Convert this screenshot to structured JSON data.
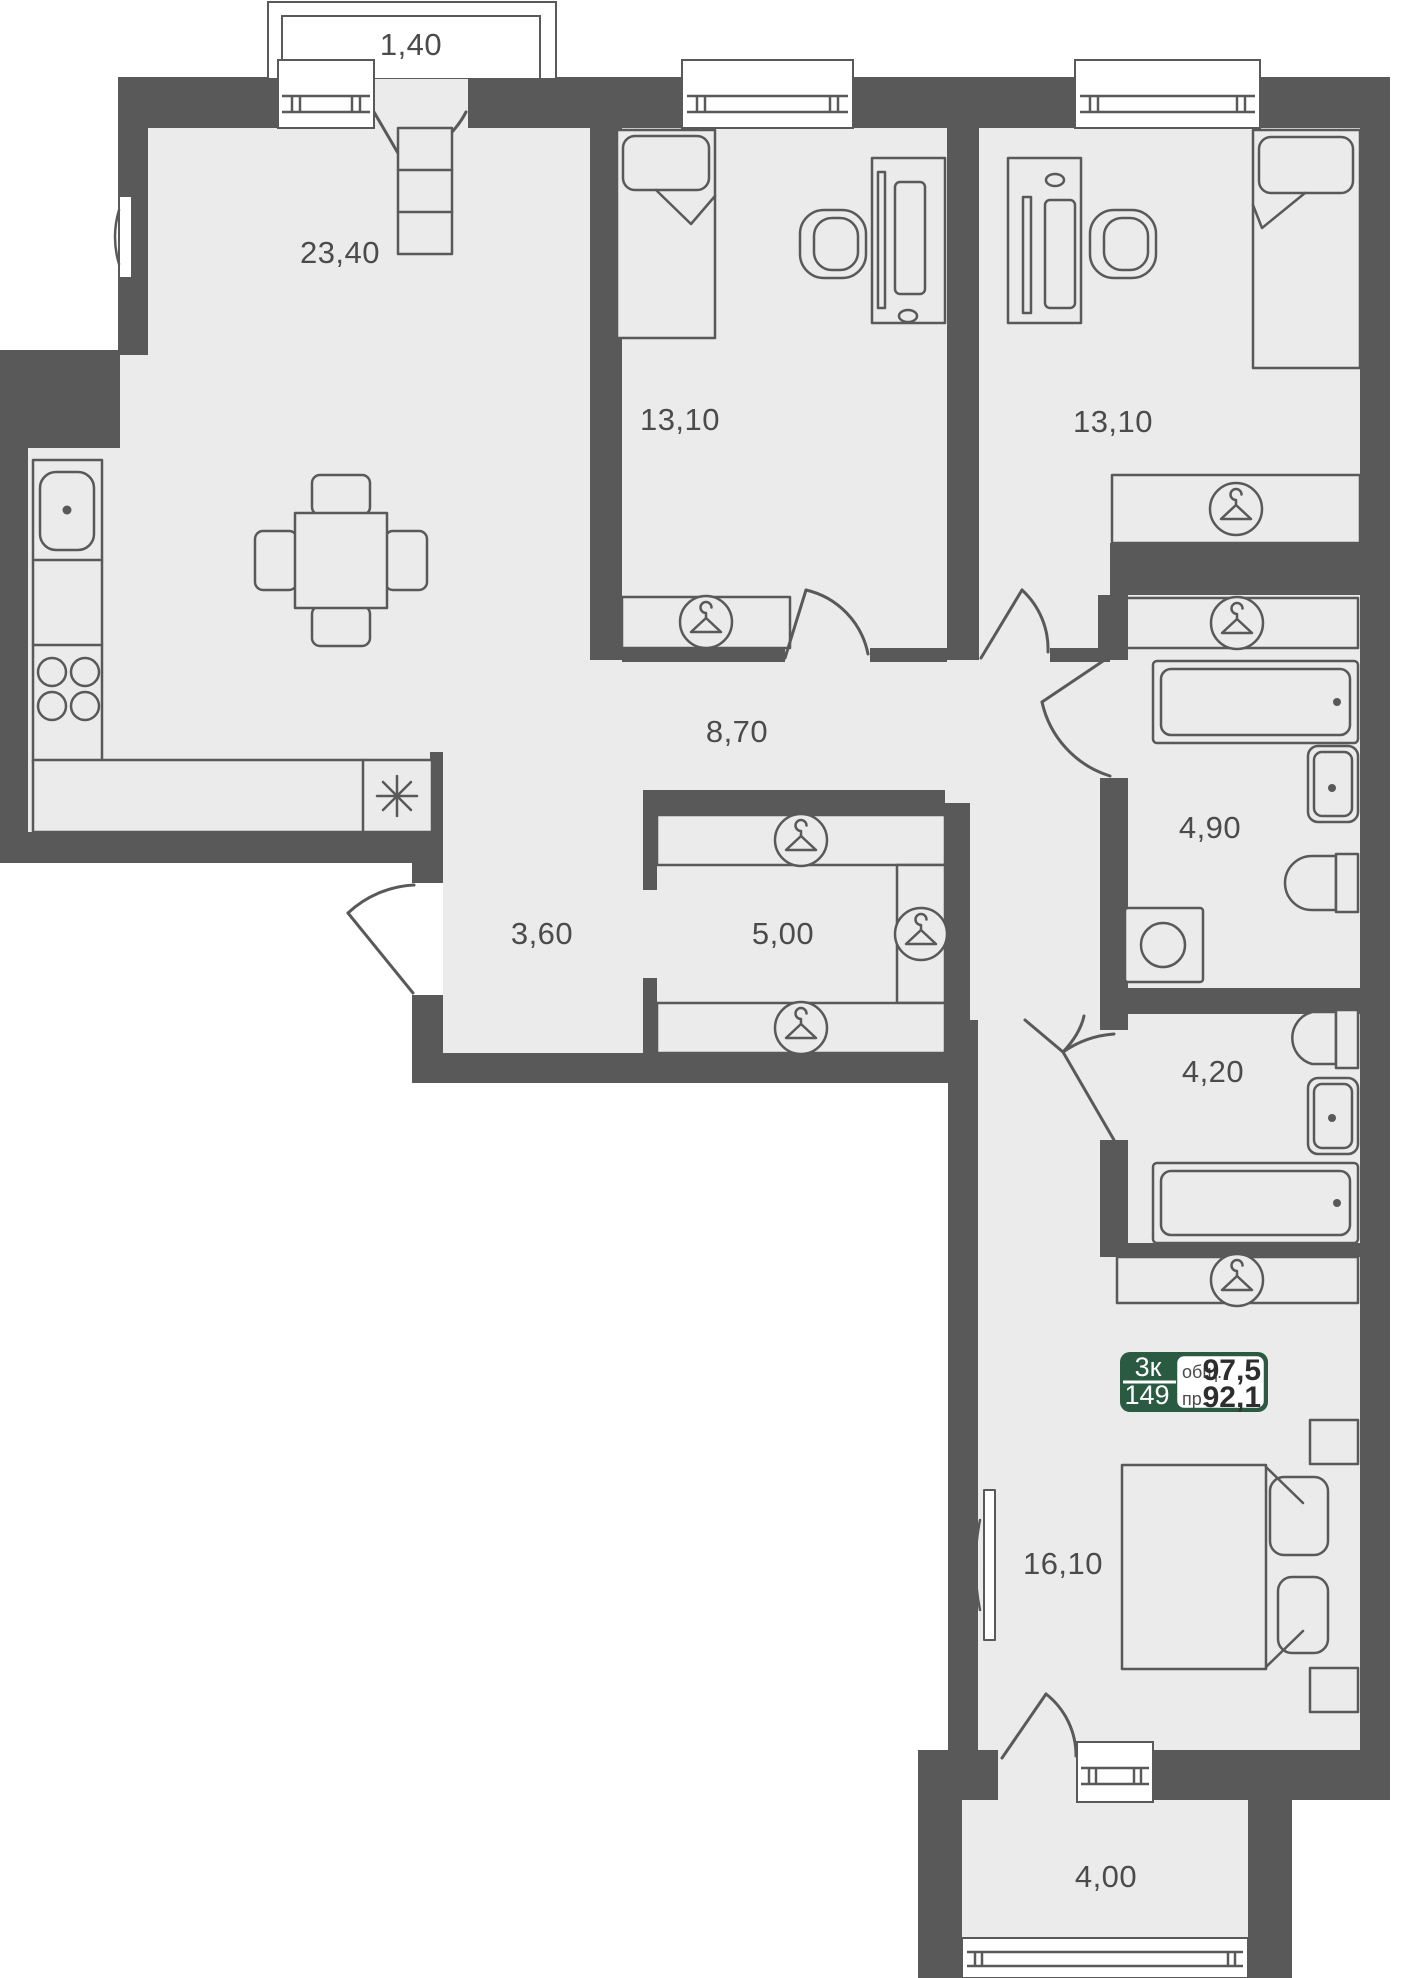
{
  "rooms": {
    "balcony_top": {
      "area": "1,40"
    },
    "living_kitchen": {
      "area": "23,40"
    },
    "bedroom_1": {
      "area": "13,10"
    },
    "bedroom_2": {
      "area": "13,10"
    },
    "hallway": {
      "area": "8,70"
    },
    "bathroom_1": {
      "area": "4,90"
    },
    "hall": {
      "area": "3,60"
    },
    "wardrobe": {
      "area": "5,00"
    },
    "bathroom_2": {
      "area": "4,20"
    },
    "bedroom_3": {
      "area": "16,10"
    },
    "balcony_bottom": {
      "area": "4,00"
    }
  },
  "badge": {
    "rooms_count": "3к",
    "unit_number": "149",
    "total_label": "общ.",
    "total_value": "97,5",
    "reduced_label": "пр.",
    "reduced_value": "92,1"
  },
  "colors": {
    "wall": "#595959",
    "floor": "#ebebeb",
    "badge_green": "#2a5a41",
    "label_text": "#4b4b4b"
  }
}
